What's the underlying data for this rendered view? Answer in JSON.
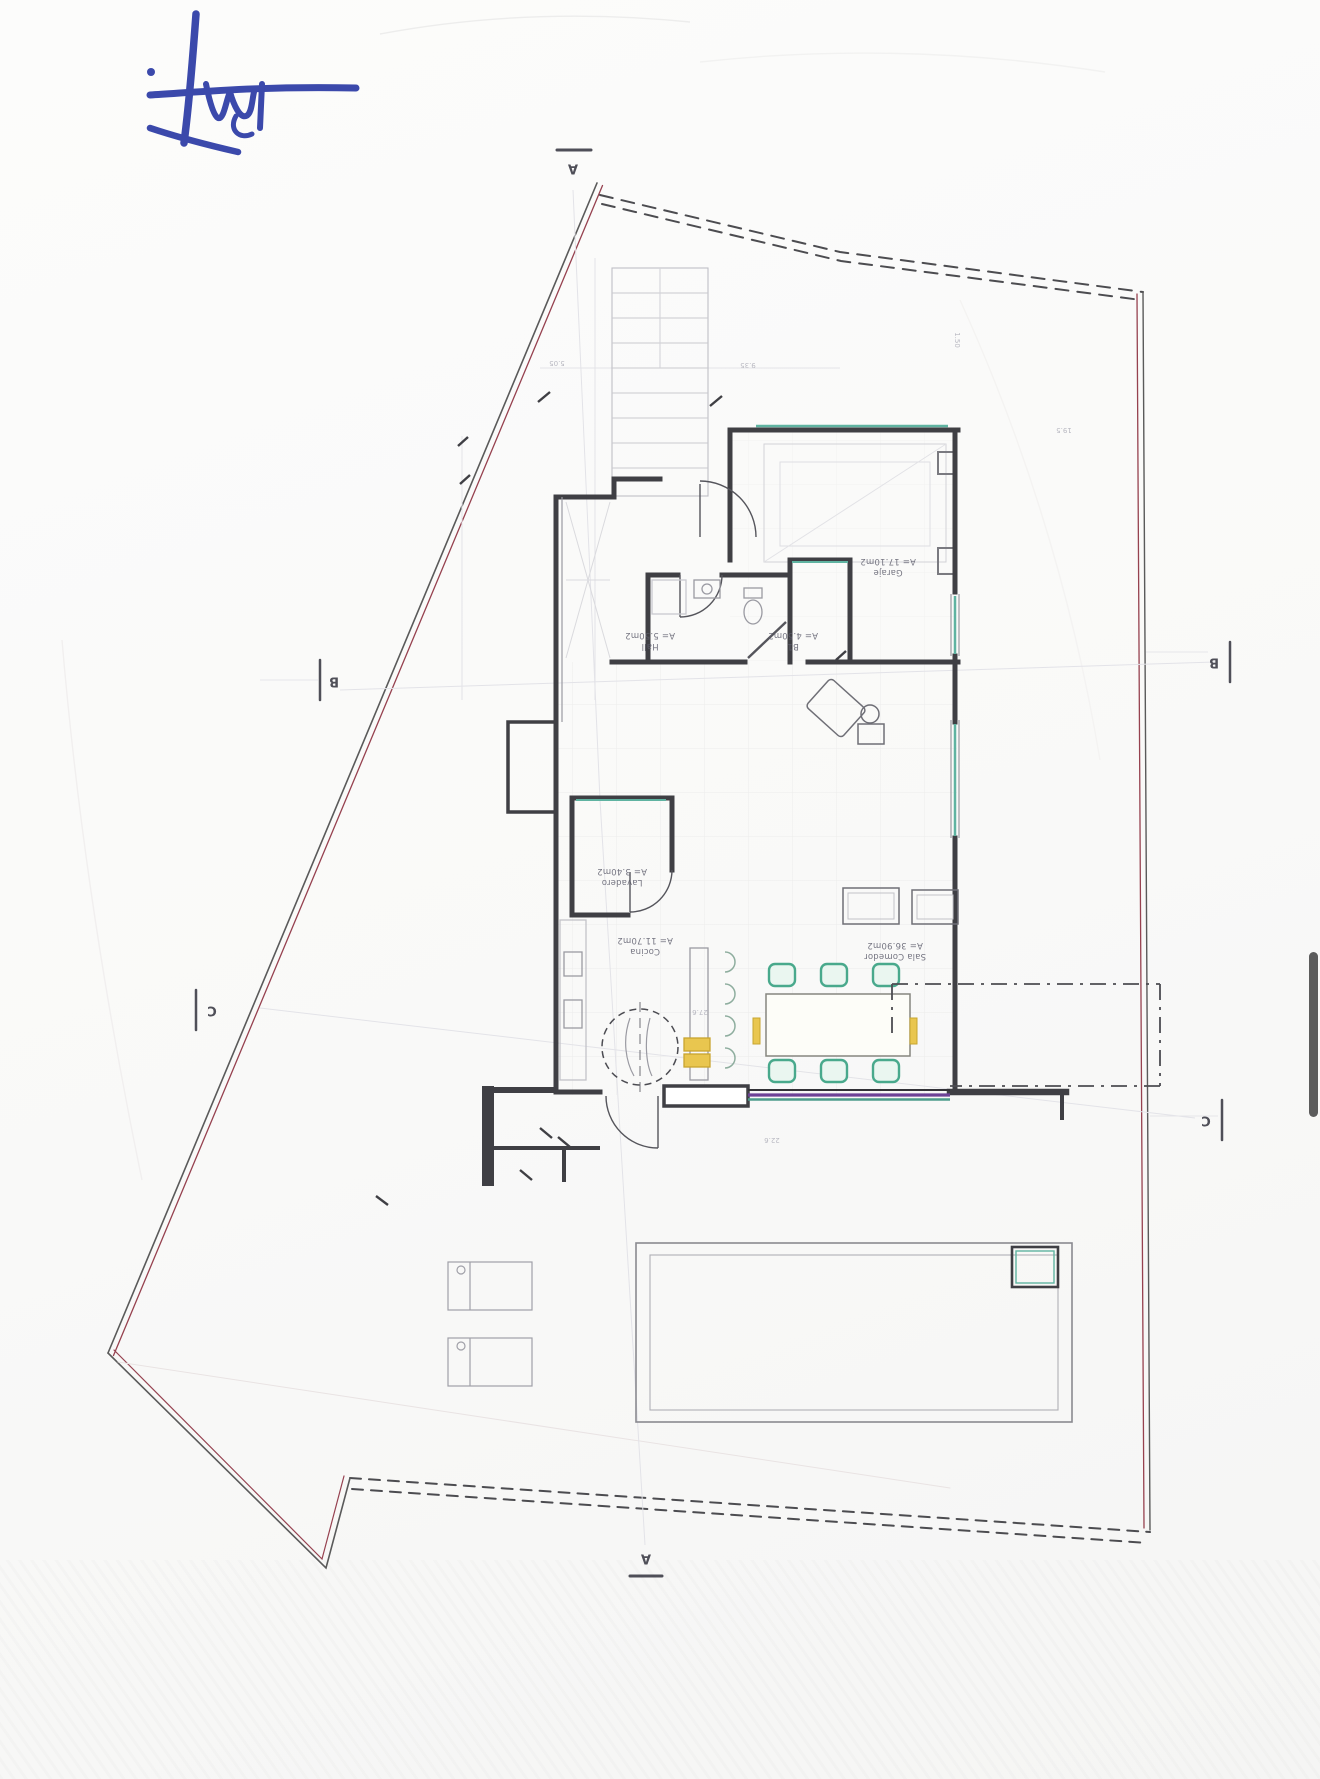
{
  "document": {
    "kind": "scanned architectural site / floor plan, drawing oriented upside-down",
    "paper_color": "#fafaf9"
  },
  "signature": {
    "description": "handwritten blue ink signature, top-left of page",
    "color": "#2b3aa5"
  },
  "colors": {
    "boundary_red": "#96414f",
    "boundary_dark": "#5a5a5a",
    "wall": "#3f3f44",
    "glazing_teal": "#5fb3a1",
    "accent_yellow": "#e9c64f",
    "chair_green": "#49a98c",
    "slider_purple": "#6d4296",
    "faint_line": "#dcdce0",
    "scrollbar": "#5c5c5c"
  },
  "plan": {
    "rooms": [
      {
        "name": "Garaje",
        "area": "A= 17.10m2"
      },
      {
        "name": "Hall",
        "area": "A= 5.50m2"
      },
      {
        "name": "B1",
        "area": "A= 4.50m2"
      },
      {
        "name": "Lavadero",
        "area": "A= 3.40m2"
      },
      {
        "name": "Cocina",
        "area": "A= 11.70m2"
      },
      {
        "name": "Sala Comedor",
        "area": "A= 36.90m2"
      }
    ],
    "section_markers": [
      {
        "label": "A",
        "position": "top"
      },
      {
        "label": "A",
        "position": "bottom"
      },
      {
        "label": "B",
        "position": "left"
      },
      {
        "label": "B",
        "position": "right"
      },
      {
        "label": "C",
        "position": "left"
      },
      {
        "label": "C",
        "position": "right"
      }
    ],
    "dimensions": [
      {
        "text": "5.05"
      },
      {
        "text": "9.35"
      },
      {
        "text": "19.5"
      },
      {
        "text": "27.6"
      },
      {
        "text": "22.6"
      },
      {
        "text": "1.50"
      }
    ],
    "features": [
      "property-boundary",
      "exterior-stairs",
      "garage",
      "hall",
      "bathroom",
      "laundry",
      "kitchen-with-island",
      "spiral-element",
      "dining-table-6-chairs",
      "sofa-group",
      "terrace-dashdot",
      "swimming-pool",
      "sun-loungers",
      "sliding-glass-door",
      "entry-porch"
    ]
  }
}
